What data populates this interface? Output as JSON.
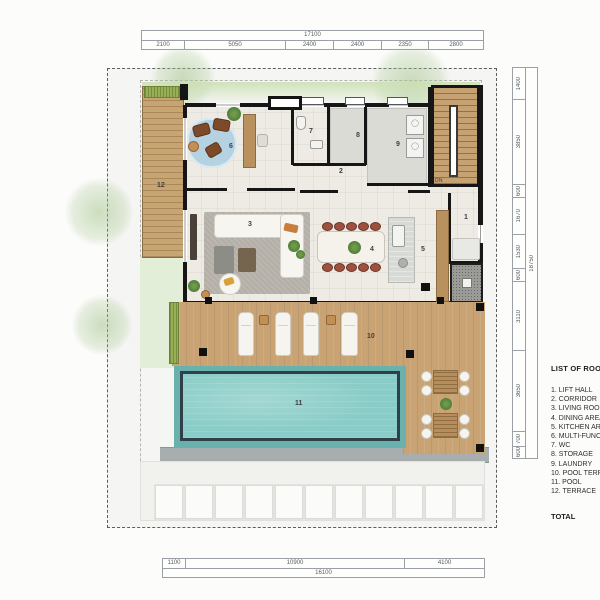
{
  "dims": {
    "top": {
      "total": "17100",
      "segments": [
        "2100",
        "5050",
        "2400",
        "2400",
        "2350",
        "2800"
      ]
    },
    "bottom": {
      "total": "16100",
      "segments": [
        "1100",
        "10900",
        "4100"
      ]
    },
    "right": {
      "total": "18750",
      "segments": [
        "1400",
        "3850",
        "600",
        "1670",
        "1530",
        "600",
        "3110",
        "3650",
        "700",
        "600"
      ]
    }
  },
  "rooms": [
    {
      "num": "1",
      "name": "LIFT HALL"
    },
    {
      "num": "2",
      "name": "CORRIDOR"
    },
    {
      "num": "3",
      "name": "LIVING ROOM"
    },
    {
      "num": "4",
      "name": "DINING AREA"
    },
    {
      "num": "5",
      "name": "KITCHEN AREA"
    },
    {
      "num": "6",
      "name": "MULTI-FUNCTION"
    },
    {
      "num": "7",
      "name": "WC"
    },
    {
      "num": "8",
      "name": "STORAGE"
    },
    {
      "num": "9",
      "name": "LAUNDRY"
    },
    {
      "num": "10",
      "name": "POOL TERRACE"
    },
    {
      "num": "11",
      "name": "POOL"
    },
    {
      "num": "12",
      "name": "TERRACE"
    }
  ],
  "room_list": {
    "title": "LIST OF ROOMS",
    "items": [
      "1. LIFT HALL",
      "2. CORRIDOR",
      "3. LIVING ROOM",
      "4. DINING AREA",
      "5. KITCHEN AREA",
      "6. MULTI-FUNCTION",
      "7. WC",
      "8. STORAGE",
      "9. LAUNDRY",
      "10. POOL TERRACE",
      "11. POOL",
      "12. TERRACE"
    ],
    "total_label": "TOTAL"
  },
  "stairs": {
    "dn_label": "DN"
  },
  "colors": {
    "pool_water": "#8accc7",
    "pool_frame": "#2f4049",
    "deck_wood": "#c9a373",
    "wall": "#161616",
    "grass": "#97b055",
    "floor": "#edebe4"
  }
}
